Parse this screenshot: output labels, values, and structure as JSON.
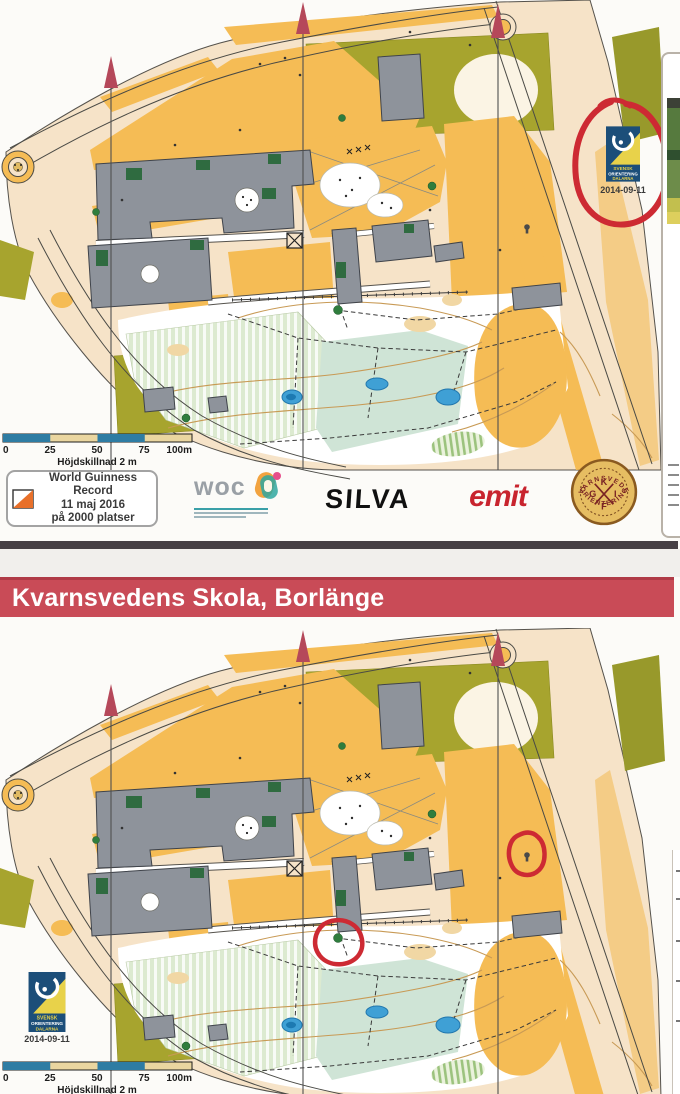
{
  "banner": {
    "title": "Kvarnsvedens Skola, Borlänge",
    "bg": "#c94b57"
  },
  "scale_bar": {
    "ticks": [
      "0",
      "25",
      "50",
      "75",
      "100m"
    ],
    "caption": "Höjdskillnad 2 m"
  },
  "record": {
    "line1": "World Guinness Record",
    "line2": "11 maj 2016",
    "line3": "på 2000 platser"
  },
  "sponsors": {
    "woc_label": "woc",
    "silva_label": "SILVA",
    "emit_label": "emit"
  },
  "club": {
    "name_top": "KVARNSVEDEN",
    "name_bottom": "ORIENTERING",
    "letters": [
      "K",
      "G",
      "I",
      "F"
    ]
  },
  "org_logo": {
    "line1": "SVENSK",
    "line2": "ORIENTERING",
    "line3": "DALARNA",
    "date": "2014-09-11"
  },
  "colors": {
    "banner_red": "#c94b57",
    "annotation_red": "#cd2a33",
    "map_orange": "#f5bc55",
    "map_olive": "#a7a42e",
    "map_building_gray": "#8e939b",
    "map_paved_tan": "#f6e3c8",
    "pond_blue": "#3fa0d5",
    "north_arrow": "#b5485a",
    "scale_blue": "#2e7ca3",
    "scale_tan": "#ead6a0",
    "logo_blue": "#1c4e79",
    "logo_yellow": "#e8d24a"
  }
}
